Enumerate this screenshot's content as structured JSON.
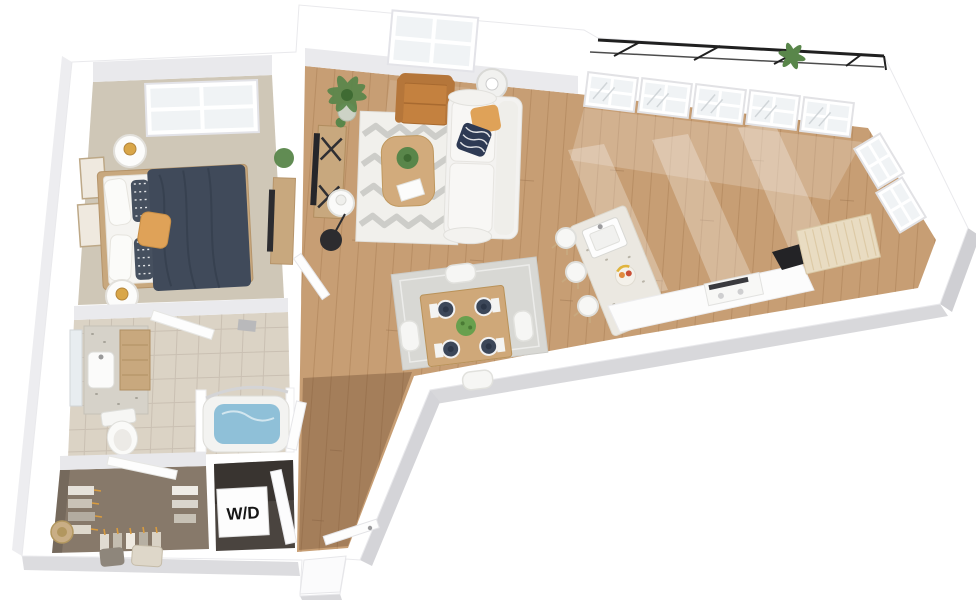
{
  "labels": {
    "washer_dryer": "W/D"
  },
  "colors": {
    "wall": "#ffffff",
    "wall_inner_face": "#e9e9ec",
    "wall_side_shade": "#d8d8db",
    "wood_floor": "#c79e74",
    "wood_plank_line": "#ab8157",
    "hall_shade": "#5a3c24",
    "carpet_bedroom": "#cfc7b7",
    "carpet_closet": "#87796a",
    "tile_bath": "#dbd3c5",
    "tile_line": "#c6bcae",
    "rug_living": "#f1f0ec",
    "rug_pattern": "#a9a9a5",
    "rug_dining": "#d8d8d4",
    "sofa": "#f3f2f0",
    "duvet": "#404a5a",
    "pillow_accent": "#dfa258",
    "leather_chair": "#c4813f",
    "bed_frame_wood": "#c8a87e",
    "island": "#ebe8e1",
    "counter_cabinet": "#e9dcc2",
    "tub_water": "#8fc0d8",
    "plant_green": "#59864a",
    "railing": "#202020",
    "glass": "#f0f3f5",
    "appliance_dark": "#232326",
    "wd_box": "#fdfdfd",
    "wd_text_color": "#161616"
  }
}
